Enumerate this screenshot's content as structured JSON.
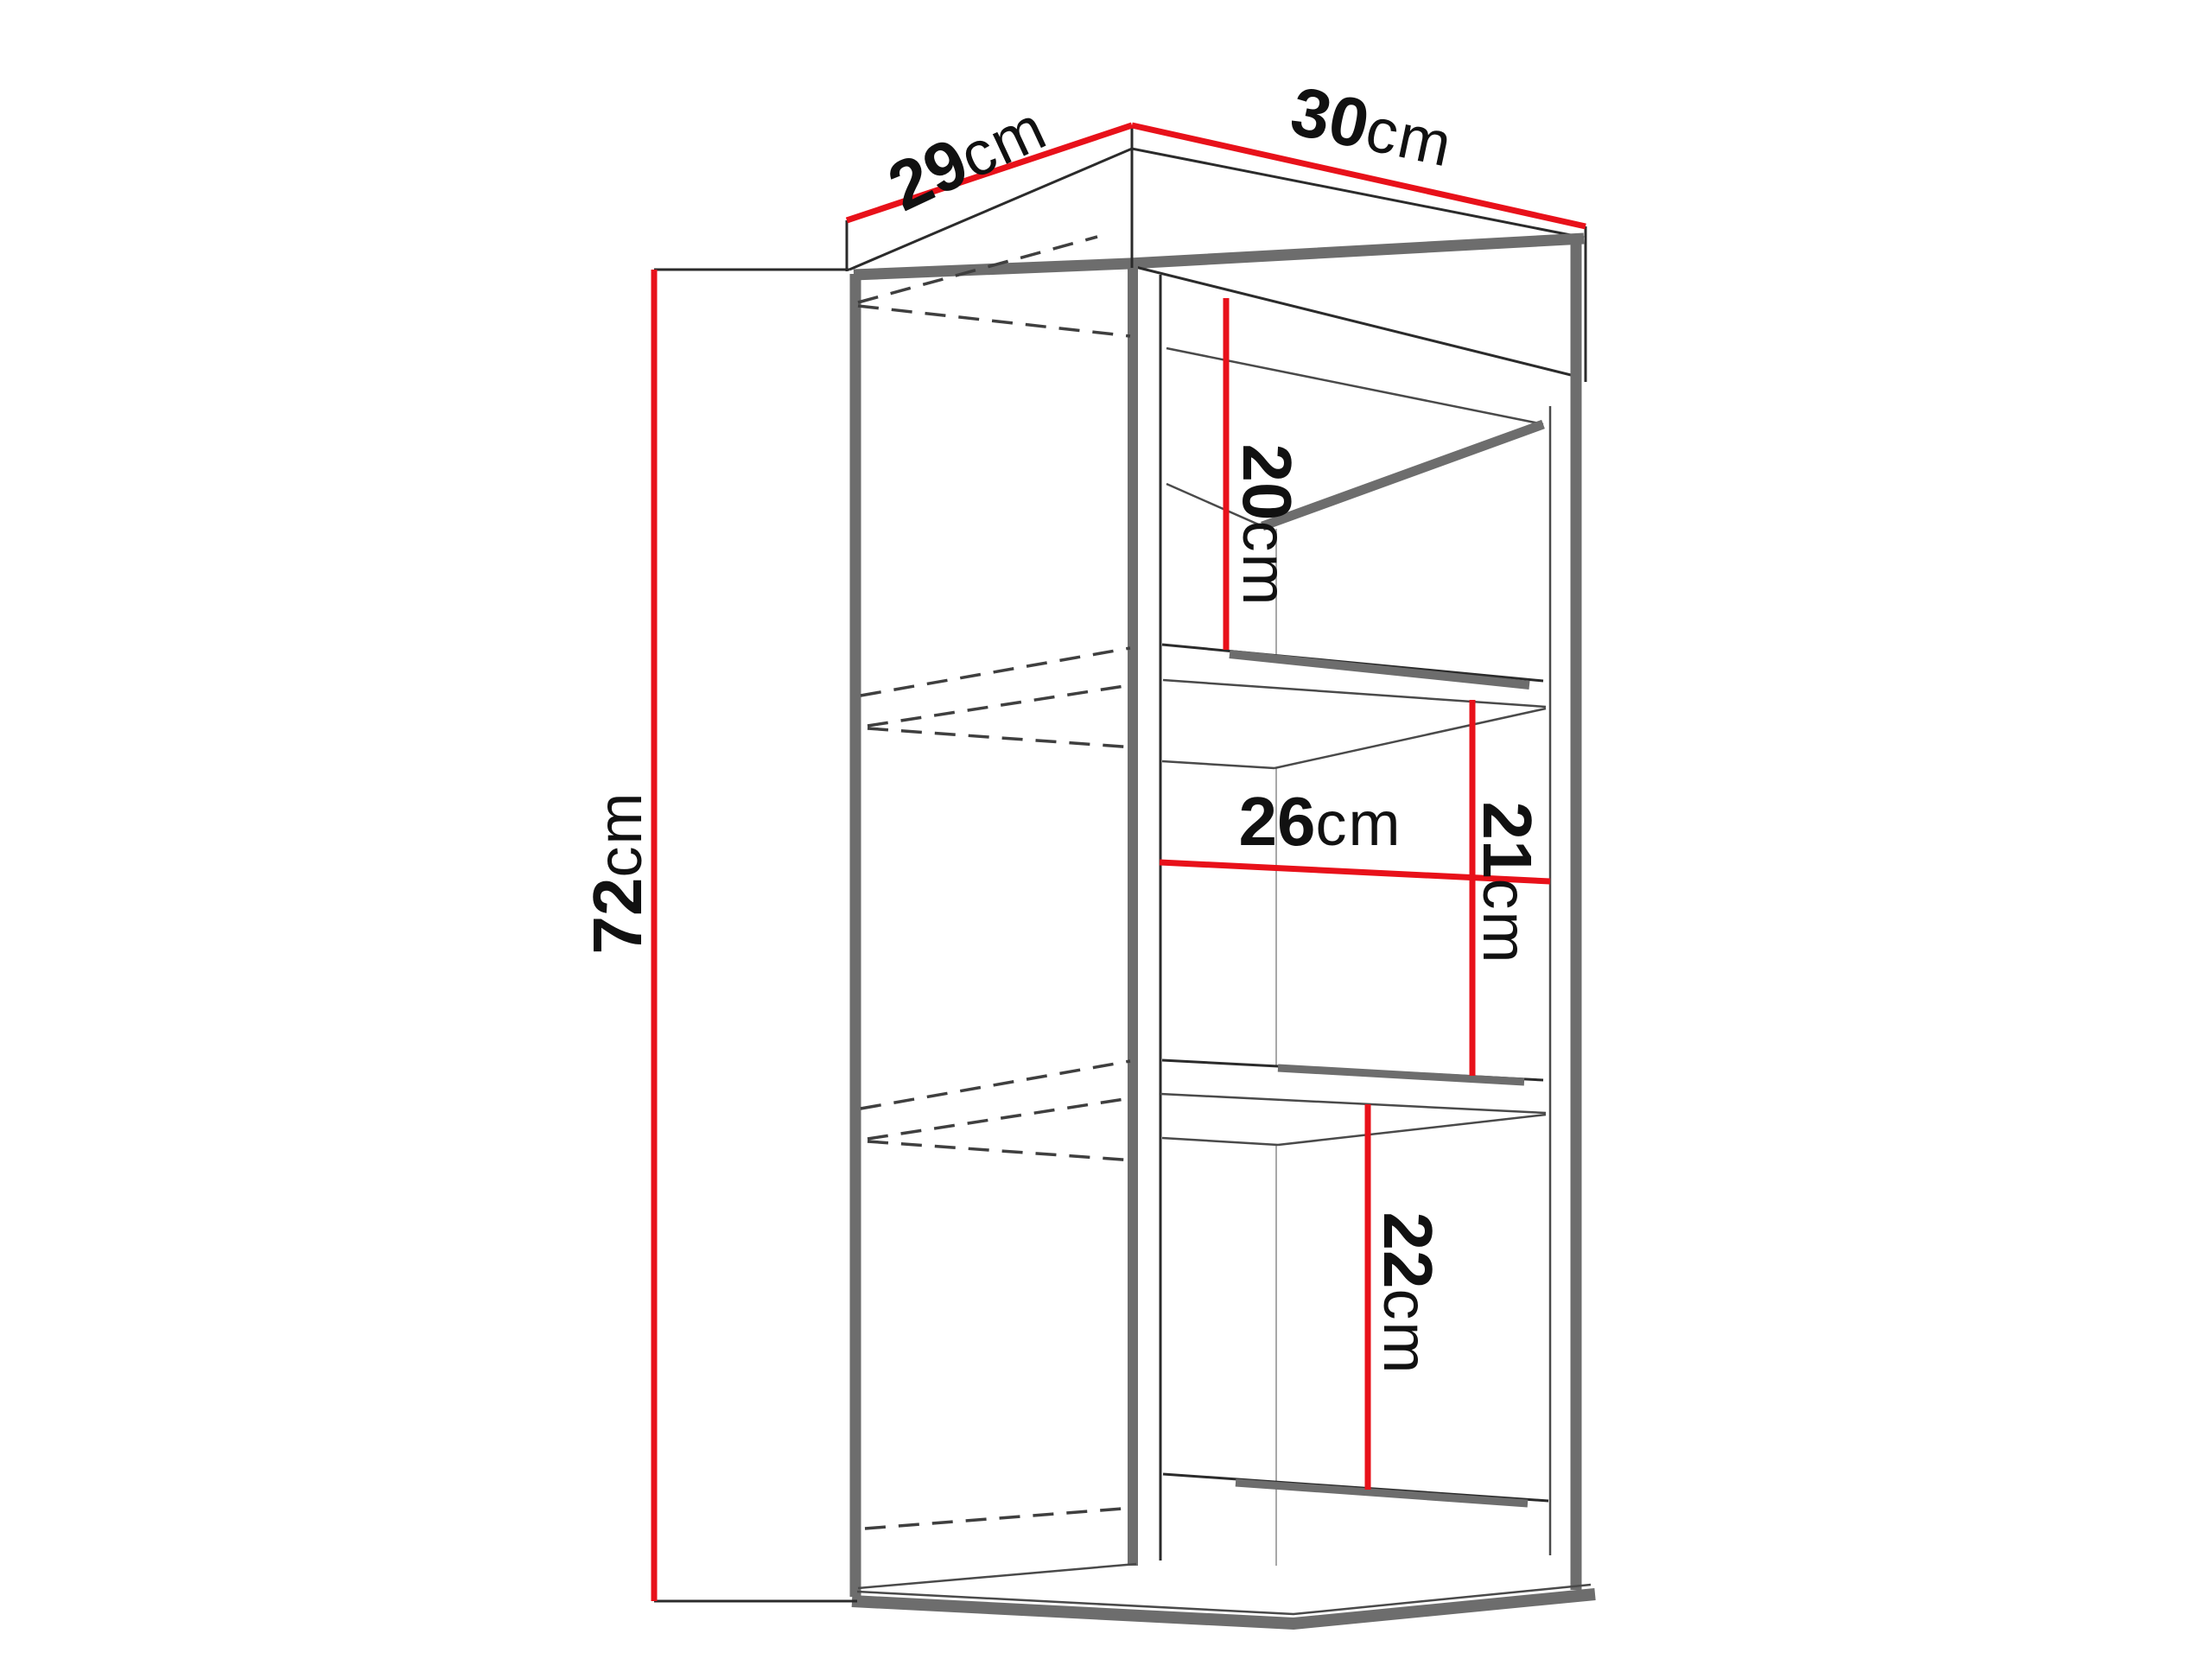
{
  "diagram": {
    "type": "furniture-dimension-diagram",
    "subject": "wall-hung cabinet with three open compartments",
    "unit": "cm",
    "colors": {
      "dimension_line": "#e8111a",
      "panel_edge_gray": "#6d6d6d",
      "outline_dark": "#2b2b2b",
      "hidden_edge_dash": "#3f3f3f",
      "background": "#ffffff",
      "text": "#111111"
    },
    "dimensions": {
      "top_depth": {
        "value": "29",
        "unit": "cm",
        "meaning": "cabinet depth along top left edge"
      },
      "top_width": {
        "value": "30",
        "unit": "cm",
        "meaning": "cabinet width along top right edge"
      },
      "height": {
        "value": "72",
        "unit": "cm",
        "meaning": "overall cabinet height"
      },
      "compartment_top": {
        "value": "20",
        "unit": "cm",
        "meaning": "top compartment interior height"
      },
      "interior_width": {
        "value": "26",
        "unit": "cm",
        "meaning": "interior width of middle compartment"
      },
      "compartment_mid": {
        "value": "21",
        "unit": "cm",
        "meaning": "middle compartment interior height"
      },
      "compartment_bot": {
        "value": "22",
        "unit": "cm",
        "meaning": "bottom compartment interior height"
      }
    }
  }
}
